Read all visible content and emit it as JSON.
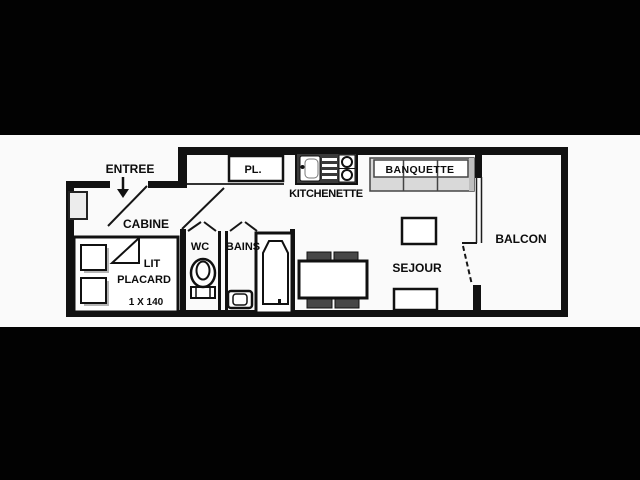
{
  "colors": {
    "background": "#020202",
    "paper": "#fafafa",
    "line": "#111111",
    "banquette_fill": "#d9d9d9",
    "banquette_arm_fill": "#bfbfbf",
    "kitchen_unit_fill": "#3a3a3a",
    "chair_fill": "#474747",
    "radiator_fill": "#ececec"
  },
  "floorplan": {
    "rooms": {
      "entree": "ENTREE",
      "cabine": "CABINE",
      "wc": "WC",
      "bains": "BAINS",
      "kitchenette": "KITCHENETTE",
      "sejour": "SEJOUR",
      "balcon": "BALCON"
    },
    "furniture": {
      "placard": "PL.",
      "banquette": "BANQUETTE",
      "bed_line1": "LIT",
      "bed_line2": "PLACARD",
      "bed_size": "1 X 140"
    },
    "icons": [
      "entry-arrow-icon",
      "radiator-icon",
      "bed-icon",
      "shelf-icon",
      "toilet-icon",
      "washbasin-icon",
      "bathtub-icon",
      "kitchen-sink-icon",
      "stove-burners-icon",
      "dining-table-icon",
      "chair-icon",
      "banquette-icon",
      "door-swing-icon",
      "window-icon"
    ]
  }
}
